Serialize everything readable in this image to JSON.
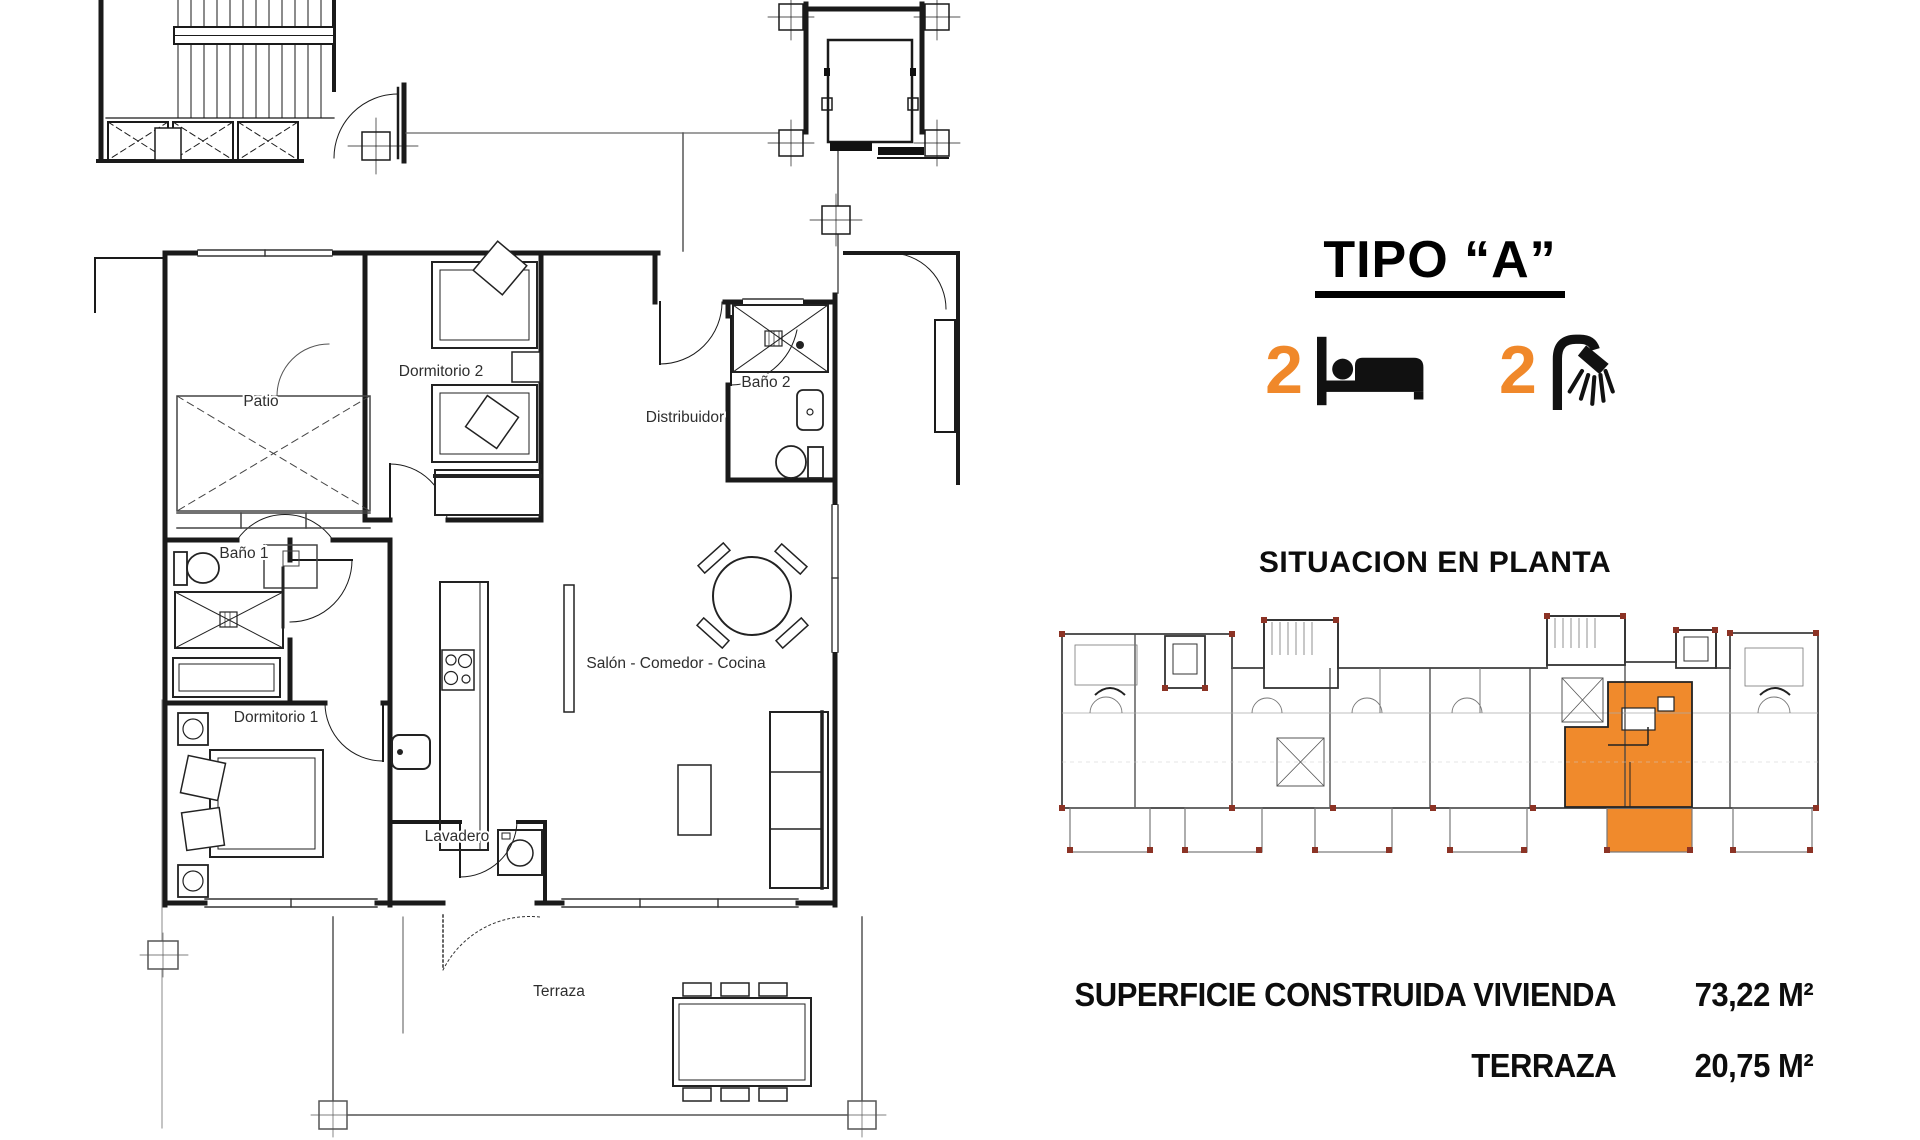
{
  "header": {
    "title": "TIPO “A”"
  },
  "features": {
    "bedrooms": {
      "count": "2",
      "icon": "bed-icon"
    },
    "bathrooms": {
      "count": "2",
      "icon": "shower-icon"
    }
  },
  "situation": {
    "heading": "SITUACION EN PLANTA"
  },
  "plan": {
    "rooms": {
      "patio": "Patio",
      "dormitorio2": "Dormitorio 2",
      "bano2": "Baño 2",
      "distribuidor": "Distribuidor",
      "bano1": "Baño 1",
      "salon": "Salón - Comedor - Cocina",
      "dormitorio1": "Dormitorio 1",
      "lavadero": "Lavadero",
      "terraza": "Terraza"
    }
  },
  "specs": {
    "rows": [
      {
        "label": "SUPERFICIE CONSTRUIDA VIVIENDA",
        "value": "73,22 M²"
      },
      {
        "label": "TERRAZA",
        "value": "20,75 M²"
      }
    ]
  },
  "colors": {
    "accent_orange": "#F0882A",
    "highlight_unit": "#F08A2C",
    "marker_red": "#8C3325",
    "wall_black": "#1A1A1A"
  }
}
